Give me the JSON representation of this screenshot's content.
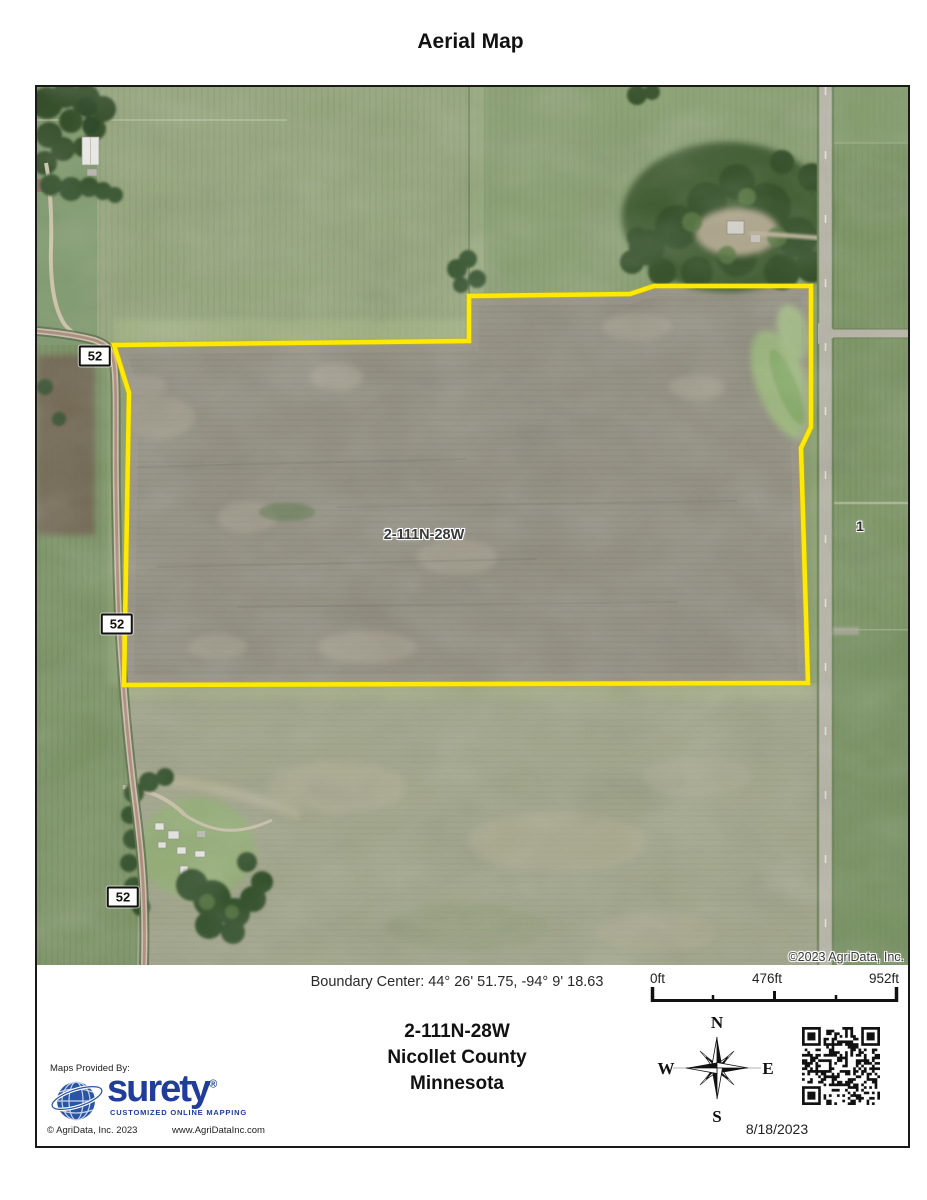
{
  "page": {
    "title": "Aerial Map"
  },
  "map": {
    "road_signs": [
      {
        "label": "52"
      },
      {
        "label": "52"
      },
      {
        "label": "52"
      }
    ],
    "parcel_label": "2-111N-28W",
    "section_label": "1",
    "copyright": "©2023 AgriData, Inc.",
    "boundary_color": "#ffe900"
  },
  "footer": {
    "boundary_center": "Boundary Center: 44° 26' 51.75,  -94° 9' 18.63",
    "scale": {
      "start": "0ft",
      "mid": "476ft",
      "end": "952ft"
    },
    "location": {
      "trs": "2-111N-28W",
      "county": "Nicollet County",
      "state": "Minnesota"
    },
    "compass": {
      "n": "N",
      "e": "E",
      "s": "S",
      "w": "W"
    },
    "date": "8/18/2023",
    "provider": {
      "label": "Maps Provided By:",
      "brand": "surety",
      "registered": "®",
      "tagline": "CUSTOMIZED ONLINE MAPPING",
      "copyright": "© AgriData, Inc. 2023",
      "website": "www.AgriDataInc.com",
      "brand_color": "#1f3d99"
    }
  }
}
